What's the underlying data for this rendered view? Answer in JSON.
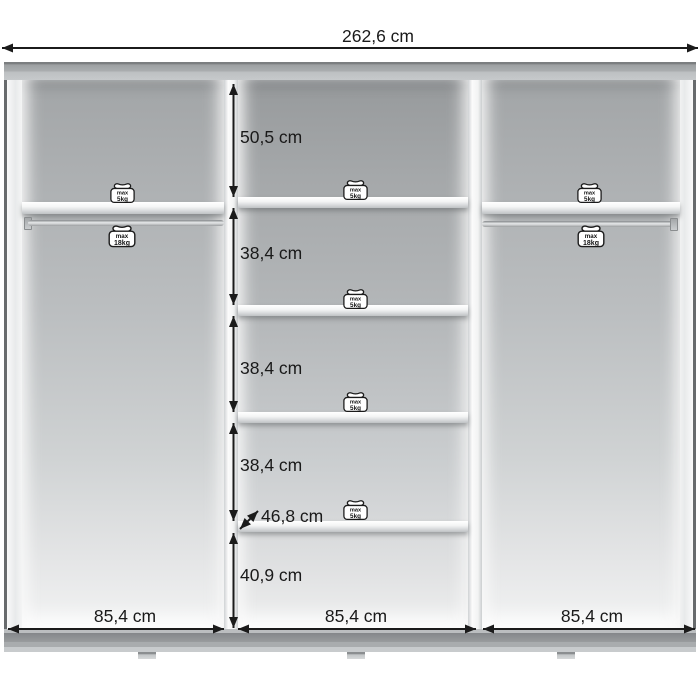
{
  "diagram_title": "wardrobe-interior-dimension-diagram",
  "units": "cm",
  "colors": {
    "background": "#ffffff",
    "dimension_line": "#1b1b1b",
    "top_board": "#a9acae",
    "base_board_dark": "#8d9092",
    "interior_top": "#9da0a2",
    "interior_bottom": "#f2f3f3",
    "shelf": "#fafafa",
    "badge_fill": "#ffffff",
    "badge_outline": "#1b1b1b"
  },
  "dimensions": {
    "total_width": {
      "label": "262,6 cm",
      "x1": 2,
      "x2": 698,
      "y": 48,
      "label_x": 378,
      "label_y": 25
    },
    "heights": [
      {
        "label": "50,5 cm",
        "y1": 84,
        "y2": 197,
        "label_y": 137
      },
      {
        "label": "38,4 cm",
        "y1": 208,
        "y2": 305,
        "label_y": 253
      },
      {
        "label": "38,4 cm",
        "y1": 316,
        "y2": 412,
        "label_y": 368
      },
      {
        "label": "38,4 cm",
        "y1": 423,
        "y2": 521,
        "label_y": 465
      },
      {
        "label": "40,9 cm",
        "y1": 533,
        "y2": 628,
        "label_y": 575
      }
    ],
    "heights_line_x": 233.5,
    "heights_label_x": 240,
    "depth": {
      "label": "46,8 cm",
      "x1": 240,
      "y1": 529,
      "x2": 258,
      "y2": 511,
      "label_x": 261,
      "label_y": 516
    },
    "section_widths": [
      {
        "label": "85,4 cm",
        "x1": 8,
        "x2": 224,
        "label_x": 125
      },
      {
        "label": "85,4 cm",
        "x1": 238,
        "x2": 476,
        "label_x": 356
      },
      {
        "label": "85,4 cm",
        "x1": 483,
        "x2": 695,
        "label_x": 592
      }
    ],
    "section_widths_y": 629,
    "section_widths_label_y": 605
  },
  "weight_badges": [
    {
      "section": "left",
      "location": "shelf",
      "line1": "max",
      "line2": "5kg",
      "x": 108,
      "y": 181,
      "w": 29
    },
    {
      "section": "left",
      "location": "rail",
      "line1": "max",
      "line2": "18kg",
      "x": 106,
      "y": 223,
      "w": 32
    },
    {
      "section": "middle",
      "location": "shelf-1",
      "line1": "max",
      "line2": "5kg",
      "x": 341,
      "y": 178,
      "w": 29
    },
    {
      "section": "middle",
      "location": "shelf-2",
      "line1": "max",
      "line2": "5kg",
      "x": 341,
      "y": 287,
      "w": 29
    },
    {
      "section": "middle",
      "location": "shelf-3",
      "line1": "max",
      "line2": "5kg",
      "x": 341,
      "y": 390,
      "w": 29
    },
    {
      "section": "middle",
      "location": "shelf-4",
      "line1": "max",
      "line2": "5kg",
      "x": 341,
      "y": 498,
      "w": 29
    },
    {
      "section": "right",
      "location": "shelf",
      "line1": "max",
      "line2": "5kg",
      "x": 575,
      "y": 181,
      "w": 29
    },
    {
      "section": "right",
      "location": "rail",
      "line1": "max",
      "line2": "18kg",
      "x": 575,
      "y": 223,
      "w": 32
    }
  ]
}
